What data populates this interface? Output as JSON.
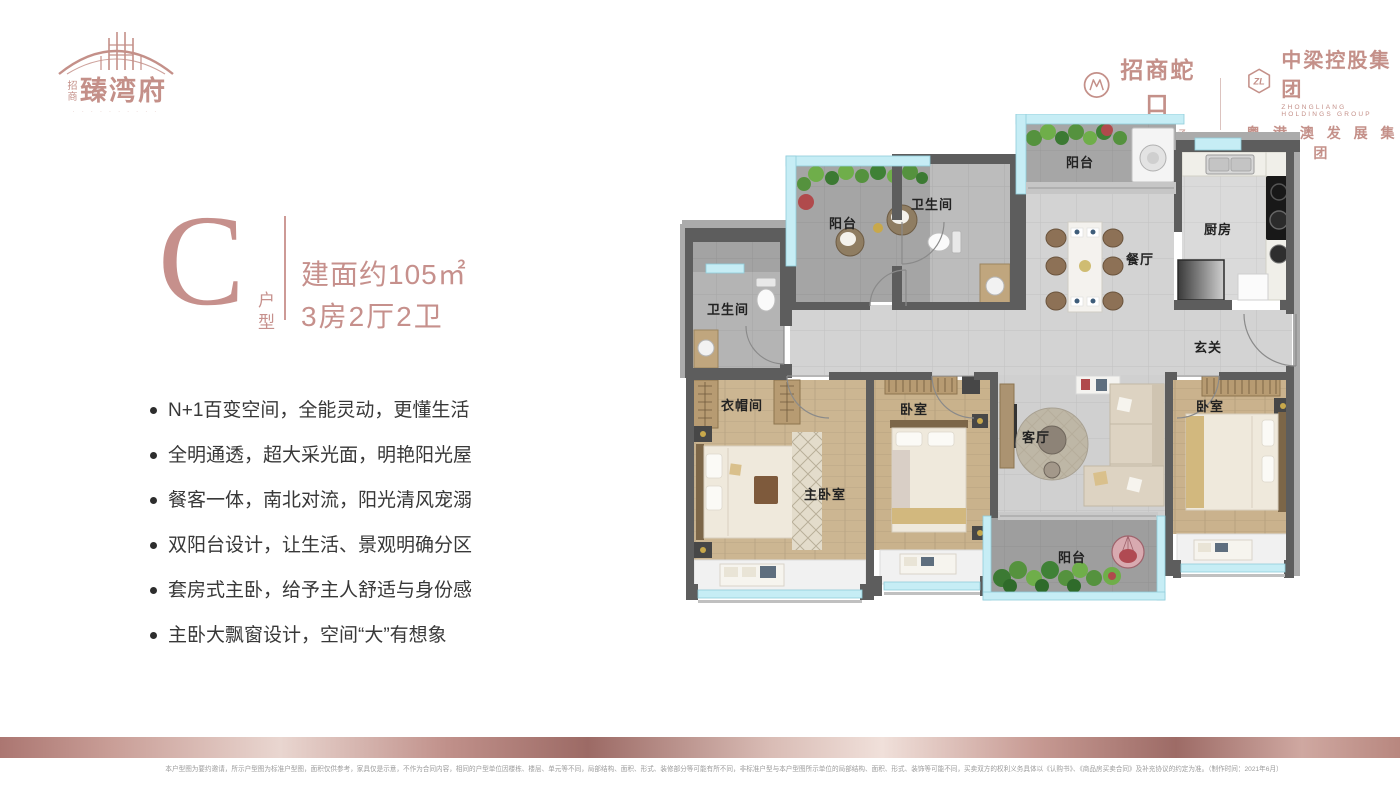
{
  "brand": {
    "prefix": "招商",
    "name": "臻湾府",
    "tagline": "· · · · · · · · · ·"
  },
  "partners": {
    "cmsk": {
      "name": "招商蛇口",
      "slogan": "美 好 生 活 承 载 者"
    },
    "zl": {
      "icon_text": "ZL",
      "name": "中梁控股集团",
      "name_en": "ZHONGLIANG HOLDINGS GROUP",
      "slogan": "粤 港 澳 发 展 集 团"
    }
  },
  "unit": {
    "letter": "C",
    "type_label": "户型",
    "area": "建面约105㎡",
    "rooms": "3房2厅2卫"
  },
  "features": [
    "N+1百变空间，全能灵动，更懂生活",
    "全明通透，超大采光面，明艳阳光屋",
    "餐客一体，南北对流，阳光清风宠溺",
    "双阳台设计，让生活、景观明确分区",
    "套房式主卧，给予主人舒适与身份感",
    "主卧大飘窗设计，空间“大”有想象"
  ],
  "floorplan": {
    "rooms": {
      "balcony_tl": "阳台",
      "bath_left": "卫生间",
      "bath_mid": "卫生间",
      "balcony_top": "阳台",
      "dining": "餐厅",
      "kitchen": "厨房",
      "foyer": "玄关",
      "cloakroom": "衣帽间",
      "master_bedroom": "主卧室",
      "bedroom_mid": "卧室",
      "living": "客厅",
      "bedroom_right": "卧室",
      "balcony_bottom": "阳台"
    }
  },
  "footer": {
    "disclaimer": "本户型图为要约邀请，所示户型图为标准户型图，面积仅供参考，家具仅是示意，不作为合同内容，相同的户型单位因楼栋、楼层、单元等不同，局部结构、面积、形式、装修部分等可能有所不同，非标准户型与本户型图所示单位的局部结构、面积、形式、装饰等可能不同，买卖双方的权利义务具体以《认购书》、《商品房买卖合同》及补充协议的约定为准。（制作时间：2021年6月）"
  },
  "colors": {
    "brand_rose": "#c6908c",
    "wall_dark": "#5d5d5d",
    "glass_blue": "#c6edf5"
  }
}
